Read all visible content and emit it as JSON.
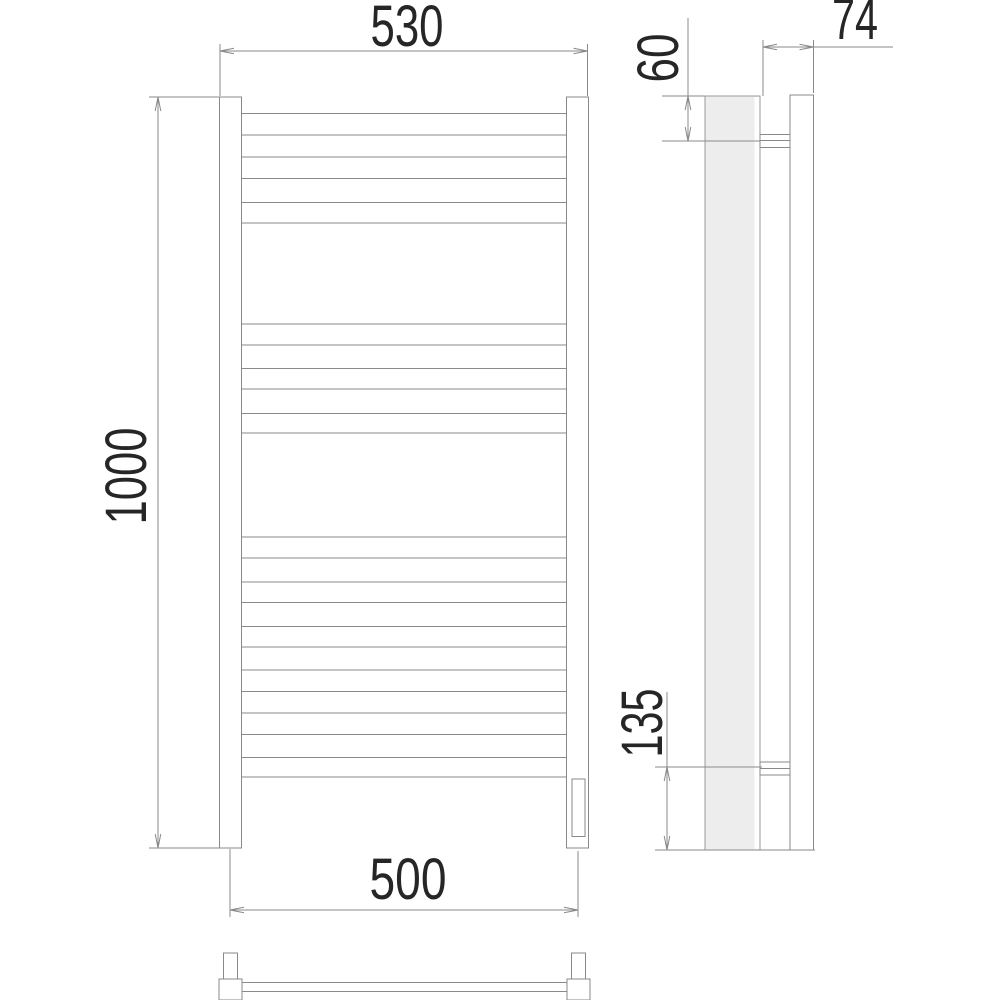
{
  "drawing": {
    "subject": "heated towel rail - orthographic technical drawing (front, side and bottom views)",
    "units": "mm",
    "dimensions": {
      "overall_width": "530",
      "overall_height": "1000",
      "mount_width": "500",
      "top_bracket_offset": "60",
      "depth": "74",
      "bottom_bracket_offset": "135"
    },
    "structure": {
      "rung_count": 12,
      "rung_groups": [
        3,
        3,
        6
      ],
      "posts": 2,
      "wall_brackets": 2
    },
    "colors": {
      "background": "#ffffff",
      "line": "#8a8a8a",
      "text": "#262626",
      "tube_fill": "#ededed"
    }
  }
}
